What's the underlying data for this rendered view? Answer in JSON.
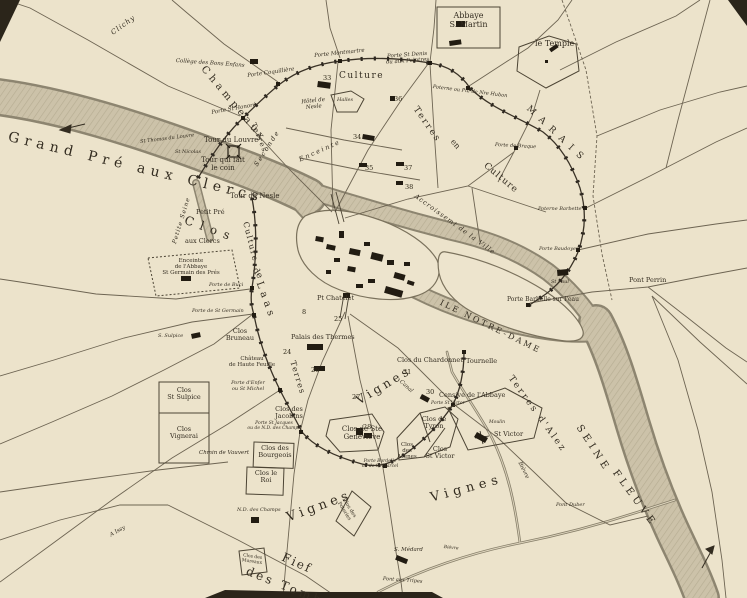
{
  "colors": {
    "paper": "#ece3cb",
    "river_fill": "#ccc2a9",
    "river_edge": "#8d8570",
    "ink": "#332c20",
    "wall": "#3a3226"
  },
  "labels": {
    "clichy": "Clichy",
    "college_bons_enfans": "Collège des Bons Enfans",
    "champeaux": "Champeaux",
    "porte_st_honore": "Porte St Honoré",
    "porte_coquilliere": "Porte Coquillière",
    "porte_montmartre": "Porte Montmartre",
    "porte_st_denis": "Porte St Denis\nou aux Peintres",
    "poterne_hubon": "Poterne ou Pte de Nre Hubon",
    "abbaye_s_martin": "Abbaye\nS. Martin",
    "le_temple": "le Temple",
    "marais": "MARAIS",
    "porte_de_braque": "Porte de Braque",
    "terres_ne": "Terres",
    "en_ne": "en",
    "culture_ne": "Culture",
    "culture_rb": "Culture",
    "halles": "Halles",
    "hotel_de_nesle": "Hôtel de\nNesle",
    "seconde": "Seconde",
    "enceinte": "Enceinte",
    "terres_rb": "Terres",
    "tour_du_louvre": "Tour du Louvre",
    "tour_qui_fait_le_coin": "Tour qui fait\nle coin",
    "st_thomas_du_louvre": "St Thomas du Louvre",
    "st_nicolas": "St Nicolas",
    "grand_pre_aux_clercs": "Grand Pré aux Clercs",
    "petite_seine": "Petite Seine",
    "tour_de_nesle": "Tour de Nesle",
    "petit_pre": "Petit Pré",
    "aux_clercs": "aux Clercs",
    "clos_big": "Clos",
    "de_big": "de",
    "laas_big": "Laas",
    "enceinte_abbaye": "Enceinte\nde l'Abbaye\nSt Germain des Prés",
    "culture_lb": "Culture",
    "porte_de_buci": "Porte de Buci",
    "porte_de_st_germain": "Porte de St Germain",
    "s_sulpice": "S. Sulpice",
    "clos_st_sulpice": "Clos\nSt Sulpice",
    "clos_vignerai": "Clos\nVignerai",
    "chemin_de_vauvert": "Chmin de Vauvert",
    "clos_bruneau": "Clos\nBruneau",
    "chateau_hautefeuille": "Château\nde Haute Feuille",
    "porte_denfer": "Porte d'Enfer\nou St Michel",
    "clos_des_jacobins": "Clos des\nJacobins",
    "porte_st_jacques": "Porte St Jacques\nou de N.D. des Champs",
    "clos_des_bourgeois": "Clos des\nBourgeois",
    "clos_le_roi": "Clos le\nRoi",
    "nd_des_champs": "N.D. des Champs",
    "clos_des_mureaux": "Clos des\nMureaux",
    "vignes_center": "Vignes",
    "vignes_sw": "Vignes",
    "vignes_se": "Vignes",
    "fief": "Fief",
    "des_tombes": "des Tombes",
    "clos_des_poteries": "Clos des\nPoteries",
    "terres_lb": "Terres",
    "palais_des_thermes": "Palais des Thermes",
    "petit_chatelet": "Pt Chatelet",
    "clos_ste_genevieve": "Clos de Ste\nGeneviève",
    "porte_bordelle": "Porte Bordelle\nou de St Marcel",
    "clos_des_arenes": "Clos\ndes\nArènes",
    "clos_de_tyron": "Clos de\nTyron",
    "clos_st_victor": "Clos\nSt Victor",
    "censive_abbaye": "Censive de l'Abbaye",
    "porte_st_victor": "Porte St Victor",
    "moulin": "Moulin",
    "moulin_st_victor": "St Victor",
    "terres_dalez": "Terres d'Alez",
    "seine": "SEINE",
    "fleuve": "FLEUVE",
    "ile_notre_dame": "ILE NOTRE-DAME",
    "clos_du_chardonnet": "Clos du Chardonnet",
    "tournelle": "Tournelle",
    "canal": "Canal",
    "bievre_upper": "Bièvre",
    "bievre_lower": "Bièvre",
    "s_medard": "S. Médard",
    "pont_aux_tripes": "Pont aux Tripes",
    "pont_duber": "Pont Duber",
    "pont_perrin": "Pont Perrin",
    "porte_barbelle": "Porte Barbelle sur l'eau",
    "porte_baudoyer": "Porte Baudoyer",
    "poterne_barbette": "Poterne Barbette",
    "st_paul": "St Paul",
    "accroissement": "Accroissemt de la Ville",
    "a_issy": "A Issy"
  },
  "numbers": {
    "n8": "8",
    "n24": "24",
    "n25": "25",
    "n26": "26",
    "n27": "27",
    "n28": "28",
    "n30": "30",
    "n31": "31",
    "n33": "33",
    "n34": "34",
    "n35": "35",
    "n36": "36",
    "n37": "37",
    "n38": "38"
  }
}
